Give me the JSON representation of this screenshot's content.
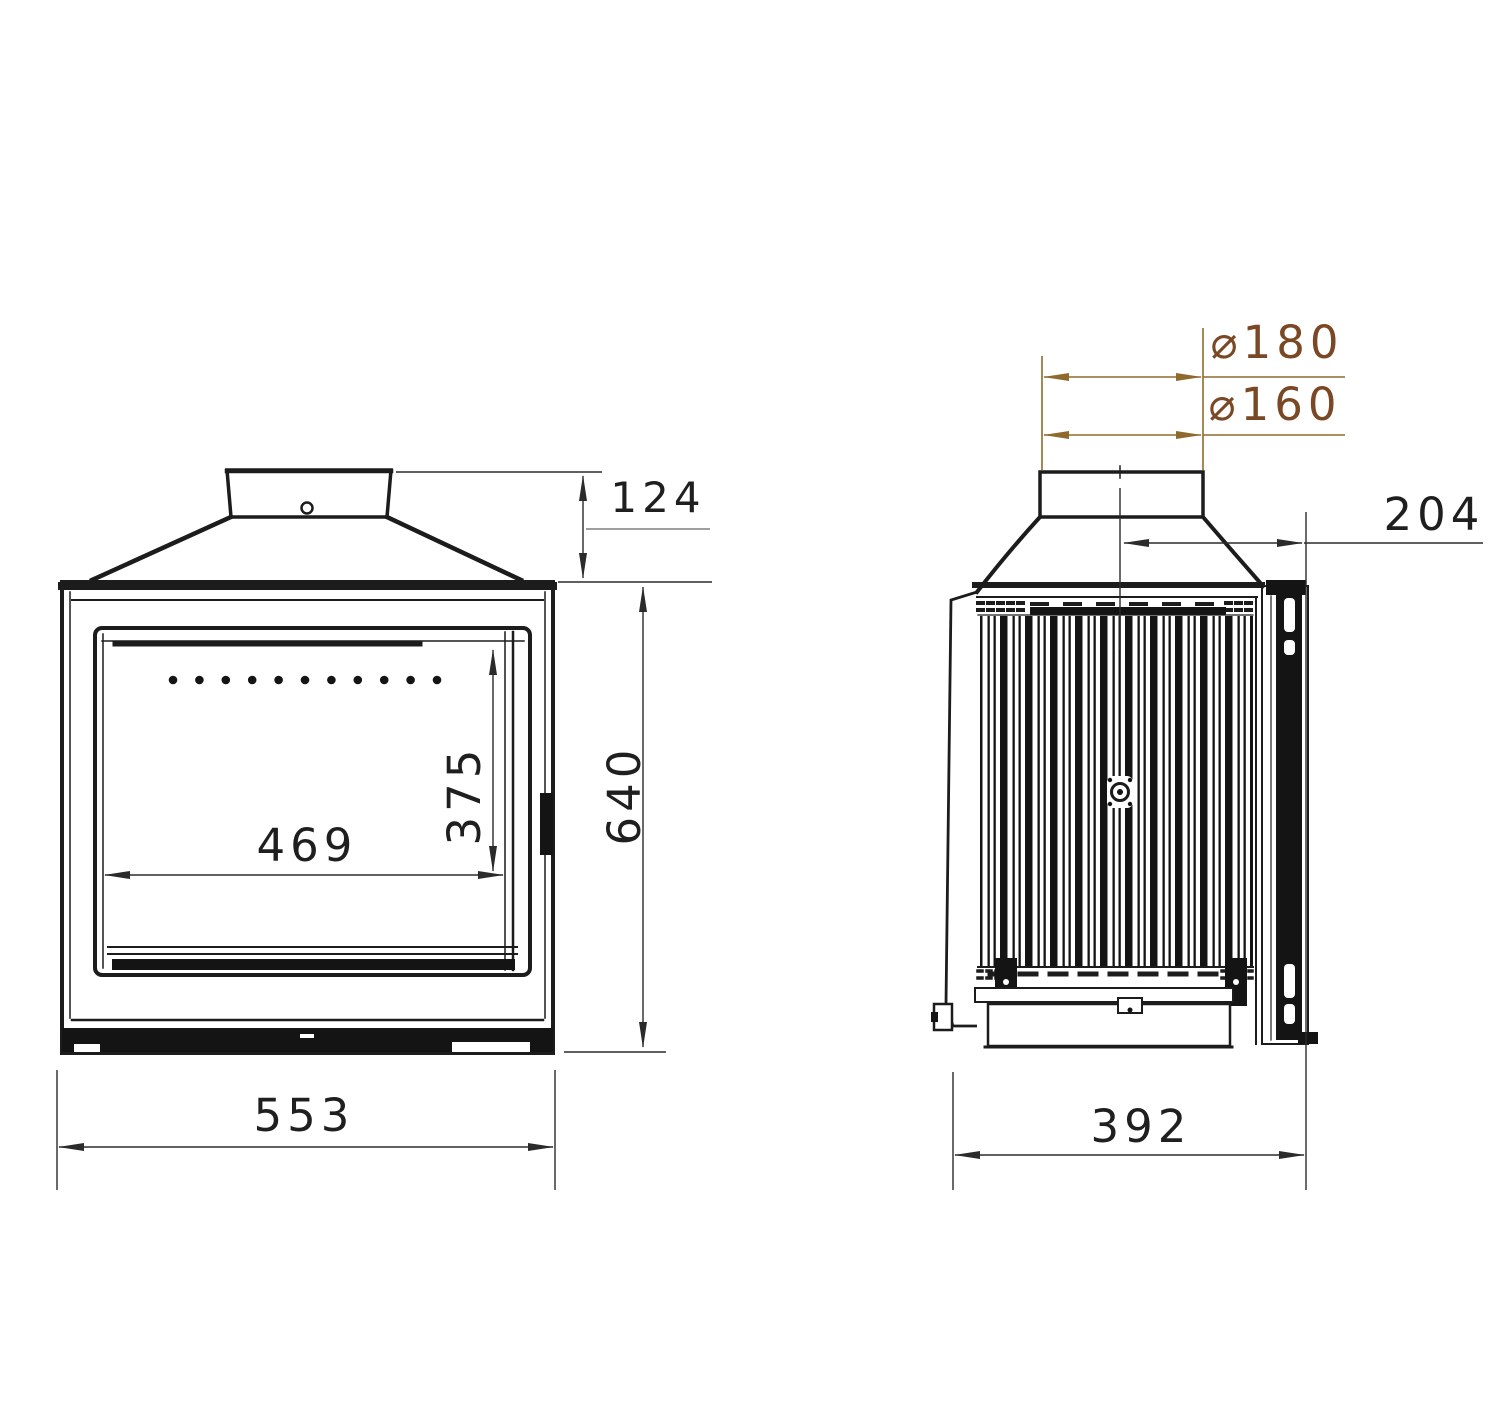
{
  "drawing": {
    "type": "technical-drawing",
    "subject": "fireplace insert stove — front and side elevation views",
    "units": "mm"
  },
  "dims": {
    "collar_height": "124",
    "overall_height": "640",
    "glass_width": "469",
    "glass_height": "375",
    "overall_width": "553",
    "flue_outer_diameter": "⌀180",
    "flue_inner_diameter": "⌀160",
    "flue_center_to_front": "204",
    "overall_depth": "392"
  },
  "colors": {
    "line": "#1c1c1c",
    "dimension_line": "#2b2b2b",
    "diameter_text": "#7a4824",
    "diameter_line": "#8e6b2c",
    "background": "#ffffff"
  }
}
